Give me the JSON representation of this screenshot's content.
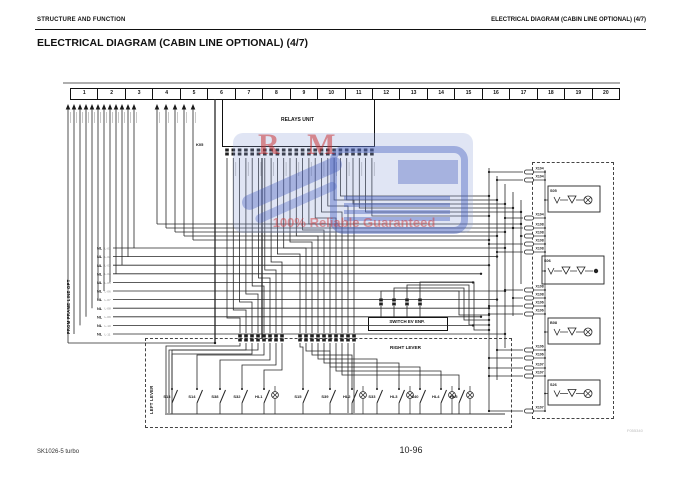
{
  "header": {
    "left": "STRUCTURE AND FUNCTION",
    "right": "ELECTRICAL DIAGRAM (CABIN LINE OPTIONAL) (4/7)"
  },
  "title": "ELECTRICAL DIAGRAM (CABIN LINE OPTIONAL) (4/7)",
  "footer": {
    "model": "SK1026-5 turbo",
    "page": "10-96",
    "fig_code": "F055340"
  },
  "watermark": {
    "letters": "R M",
    "tagline": "100% Reliable Guaranteed"
  },
  "diagram": {
    "top_strip": {
      "numbers": [
        "1",
        "2",
        "3",
        "4",
        "5",
        "6",
        "7",
        "8",
        "9",
        "10",
        "11",
        "12",
        "13",
        "14",
        "15",
        "16",
        "17",
        "18",
        "19",
        "20"
      ]
    },
    "relays_unit": {
      "label": "RELAYS UNIT",
      "connector": "K05"
    },
    "frame_line": {
      "label": "FROM FRAME LINE OPT",
      "rows": [
        {
          "tag": "NL",
          "code": "L-01"
        },
        {
          "tag": "NL",
          "code": "L-02"
        },
        {
          "tag": "NL",
          "code": "L-03"
        },
        {
          "tag": "NL",
          "code": "L-04"
        },
        {
          "tag": "NL",
          "code": "L-05"
        },
        {
          "tag": "NL",
          "code": "L-06"
        },
        {
          "tag": "NL",
          "code": "L-07"
        },
        {
          "tag": "NL",
          "code": "L-08"
        },
        {
          "tag": "NL",
          "code": "L-09"
        },
        {
          "tag": "NL",
          "code": "L-10"
        },
        {
          "tag": "NL",
          "code": "L-11"
        }
      ]
    },
    "switch_ev": {
      "label": "SWITCH EV ENP."
    },
    "levers": {
      "left_label": "LEFT LEVER",
      "right_label": "RIGHT LEVER",
      "left_switches": [
        {
          "label": "S13",
          "lamp": false
        },
        {
          "label": "S14",
          "lamp": false
        },
        {
          "label": "S38",
          "lamp": false
        },
        {
          "label": "S32",
          "lamp": false
        },
        {
          "label": "HL1",
          "lamp": true
        }
      ],
      "right_switches": [
        {
          "label": "S15",
          "lamp": false
        },
        {
          "label": "S39",
          "lamp": false
        },
        {
          "label": "HL2",
          "lamp": true
        },
        {
          "label": "S33",
          "lamp": false
        },
        {
          "label": "HL3",
          "lamp": true
        },
        {
          "label": "S40",
          "lamp": false
        },
        {
          "label": "HL4",
          "lamp": true
        },
        {
          "label": "HL5",
          "lamp": true
        }
      ]
    },
    "right_panel": {
      "pins": [
        "X104",
        "X104",
        "X104",
        "X108",
        "X108",
        "X108",
        "X108",
        "X108",
        "X108",
        "X106",
        "X106",
        "X106",
        "X106",
        "X107",
        "X107",
        "X107"
      ],
      "relays": [
        {
          "name": "S05"
        },
        {
          "name": "S06"
        },
        {
          "name": "B08"
        },
        {
          "name": "S26"
        }
      ]
    }
  }
}
